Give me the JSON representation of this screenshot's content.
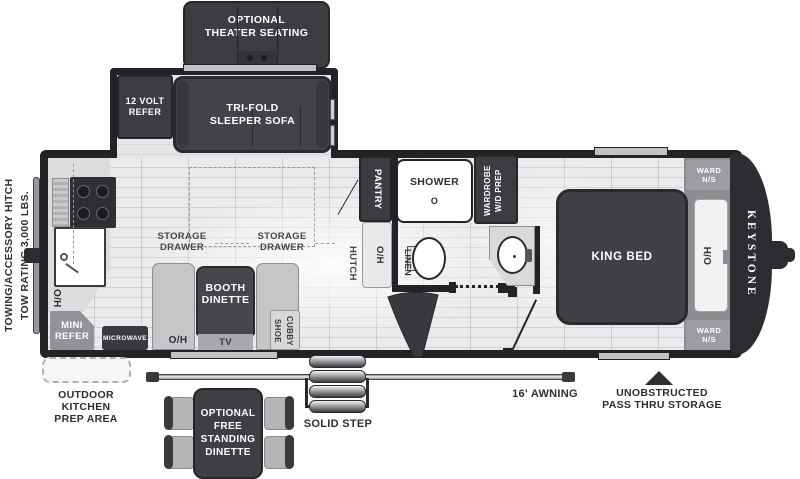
{
  "colors": {
    "wall": "#232327",
    "furniture_dark": "#3e3e43",
    "bench_gray": "#c6c6c9",
    "mid_gray": "#95959a",
    "floor": "#e7e7e9",
    "text_dark": "#2e2e33"
  },
  "rear": {
    "towing_line1": "TOWING/ACCESSORY HITCH",
    "towing_line2": "TOW RATING 3,000 LBS."
  },
  "exterior": {
    "brand": "KEYSTONE",
    "awning": "16' AWNING",
    "solid_step": "SOLID STEP",
    "pass_thru_line1": "UNOBSTRUCTED",
    "pass_thru_line2": "PASS THRU STORAGE",
    "outdoor_line1": "OUTDOOR",
    "outdoor_line2": "KITCHEN",
    "outdoor_line3": "PREP AREA"
  },
  "options": {
    "theater_line1": "OPTIONAL",
    "theater_line2": "THEATER SEATING",
    "dinette_line1": "OPTIONAL",
    "dinette_line2": "FREE",
    "dinette_line3": "STANDING",
    "dinette_line4": "DINETTE"
  },
  "living": {
    "refer12_line1": "12 VOLT",
    "refer12_line2": "REFER",
    "sofa_line1": "TRI-FOLD",
    "sofa_line2": "SLEEPER SOFA",
    "storage_line1": "STORAGE",
    "storage_line2": "DRAWER",
    "booth_line1": "BOOTH",
    "booth_line2": "DINETTE",
    "tv": "TV",
    "oh": "O/H",
    "shoe_line1": "SHOE",
    "shoe_line2": "CUBBY",
    "hutch": "HUTCH"
  },
  "kitchen": {
    "oh": "O/H",
    "mini_line1": "MINI",
    "mini_line2": "REFER",
    "microwave": "MICROWAVE"
  },
  "bath": {
    "pantry": "PANTRY",
    "shower": "SHOWER",
    "drain": "O",
    "wardrobe_line1": "WARDROBE",
    "wardrobe_line2": "W/D PREP",
    "linen": "LINEN"
  },
  "bedroom": {
    "king_bed": "KING BED",
    "oh": "O/H",
    "ward_line1": "WARD",
    "ward_line2": "N/S"
  }
}
